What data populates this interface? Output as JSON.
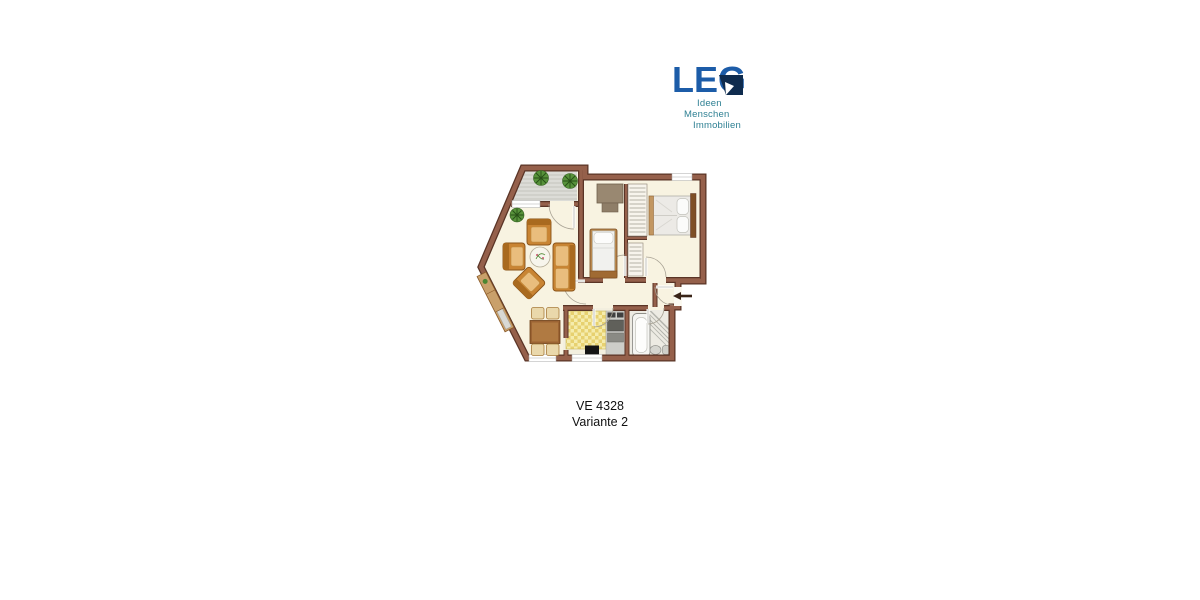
{
  "page": {
    "background": "#ffffff"
  },
  "logo": {
    "brand": "LEG",
    "tagline_lines": [
      "Ideen",
      "Menschen",
      "Immobilien"
    ],
    "brand_color": "#1c5ca8",
    "notch_color": "#0e2b4e",
    "tagline_color": "#2e8093"
  },
  "caption": {
    "line1": "VE 4328",
    "line2": "Variante 2"
  },
  "floorplan": {
    "wall_color": "#95604b",
    "wall_edge_color": "#5a3426",
    "floor_color": "#f8f3e1",
    "balcony_deck_color": "#dcdcd7",
    "kitchen_counter_color": "#f5ecac",
    "furniture_color": "#c98433",
    "plant_color": "#4c8631",
    "elements": [
      "balcony",
      "living-area",
      "dining-area",
      "kitchen",
      "bathroom",
      "hall",
      "bedroom",
      "small-room",
      "built-in-closet",
      "entrance-arrow"
    ]
  }
}
